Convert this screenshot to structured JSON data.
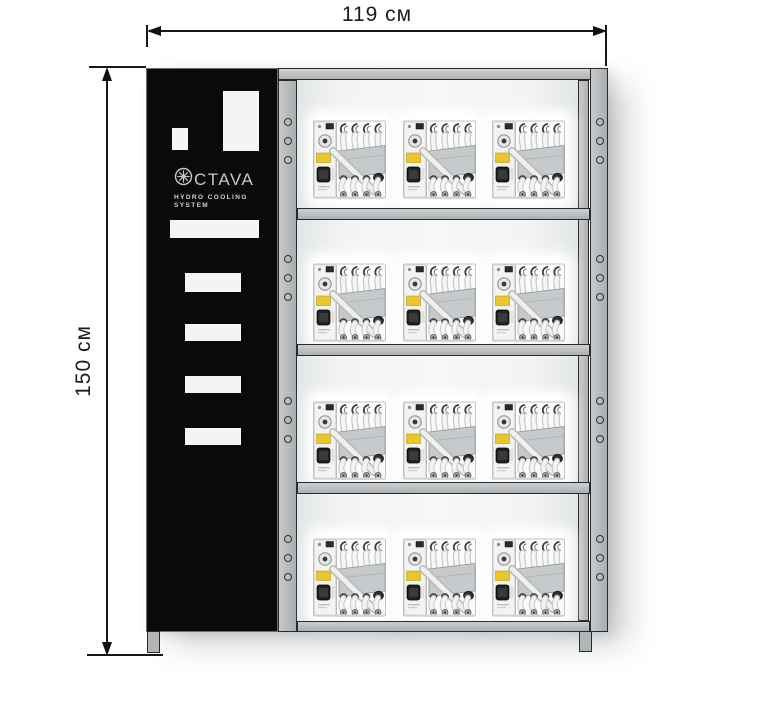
{
  "dimension_labels": {
    "width": "119 см",
    "height": "150 см"
  },
  "logo": {
    "brand": "CTAVA",
    "line1": "HYDRO COOLING",
    "line2": "SYSTEM"
  },
  "rack": {
    "rows": 4,
    "columns": 3,
    "holes_per_section": 3,
    "units_total": 12
  },
  "colors": {
    "panel_black": "#0a0a0a",
    "frame_gray": "#b3b7b9",
    "unit_label_yellow": "#e9c52e",
    "logo_gray": "#c7c7c7",
    "dimension_line": "#161616"
  }
}
